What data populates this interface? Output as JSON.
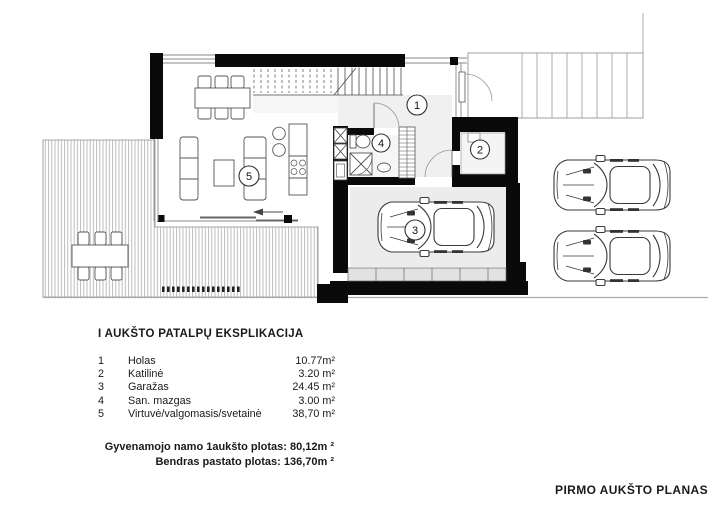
{
  "document": {
    "legend": {
      "title": "I AUKŠTO PATALPŲ EKSPLIKACIJA",
      "rooms": [
        {
          "num": "1",
          "name": "Holas",
          "area": "10.77m²"
        },
        {
          "num": "2",
          "name": "Katilinė",
          "area": "3.20 m²"
        },
        {
          "num": "3",
          "name": "Garažas",
          "area": "24.45 m²"
        },
        {
          "num": "4",
          "name": "San. mazgas",
          "area": "3.00 m²"
        },
        {
          "num": "5",
          "name": "Virtuvė/valgomasis/svetainė",
          "area": "38,70 m²"
        }
      ],
      "totals": [
        "Gyvenamojo namo  1aukšto plotas: 80,12m ²",
        "Bendras pastato  plotas: 136,70m ²"
      ]
    },
    "footer_title": "PIRMO AUKŠTO PLANAS",
    "colors": {
      "wall": "#0a0a0a",
      "line": "#555555",
      "deck_hatch": "#adadad",
      "floor_tint": "#f0f0f0"
    }
  }
}
